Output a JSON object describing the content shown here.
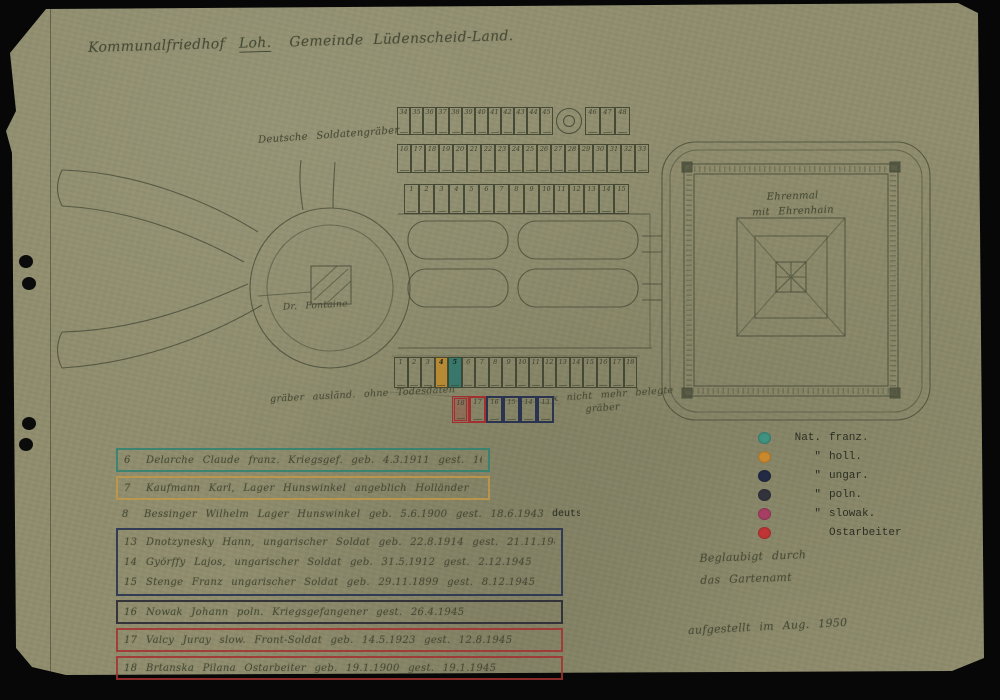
{
  "artifact": {
    "background_color": "#070707",
    "paper_color": "#8f8d6d",
    "ink_color": "#474b36"
  },
  "title": {
    "prefix": "Kommunalfriedhof",
    "underlined": "Loh.",
    "suffix": "Gemeinde Lüdenscheid-Land."
  },
  "plan": {
    "german_graves_label": "Deutsche Soldatengräber",
    "fountain_label": "Dr. Fontaine",
    "memorial_label": [
      "Ehrenmal",
      "mit Ehrenhain"
    ],
    "foreign_graves_label": "gräber ausländ. ohne Todesdaten",
    "unoccupied_note_line1": "x nicht mehr belegte",
    "unoccupied_note_line2": "gräber",
    "grids": {
      "row_top": [
        "34",
        "35",
        "36",
        "37",
        "38",
        "39",
        "40",
        "41",
        "42",
        "43",
        "44",
        "45"
      ],
      "row_top_block": [
        "46",
        "47",
        "48"
      ],
      "row_middle": [
        "16",
        "17",
        "18",
        "19",
        "20",
        "21",
        "22",
        "23",
        "24",
        "25",
        "26",
        "27",
        "28",
        "29",
        "30",
        "31",
        "32",
        "33"
      ],
      "row_bottom": [
        "1",
        "2",
        "3",
        "4",
        "5",
        "6",
        "7",
        "8",
        "9",
        "10",
        "11",
        "12",
        "13",
        "14",
        "15"
      ],
      "foreign_row": [
        "1",
        "2",
        "3",
        "4",
        "5",
        "6",
        "7",
        "8",
        "9",
        "10",
        "11",
        "12",
        "13",
        "14",
        "15",
        "16",
        "17",
        "18"
      ],
      "foreign_highlights": {
        "orange_index": 3,
        "teal_index": 4
      },
      "marked_row": [
        {
          "n": "18",
          "c": "red-heavy"
        },
        {
          "n": "17",
          "c": "red"
        },
        {
          "n": "16",
          "c": "blue"
        },
        {
          "n": "15",
          "c": "blue"
        },
        {
          "n": "14",
          "c": "blue"
        },
        {
          "n": "13",
          "c": "blue"
        }
      ]
    }
  },
  "legend": {
    "items": [
      {
        "color": "#3f9180",
        "prefix": "Nat.",
        "label": "franz."
      },
      {
        "color": "#c8892f",
        "prefix": "\"",
        "label": "holl."
      },
      {
        "color": "#232a45",
        "prefix": "\"",
        "label": "ungar."
      },
      {
        "color": "#33333d",
        "prefix": "\"",
        "label": "poln."
      },
      {
        "color": "#a63f63",
        "prefix": "\"",
        "label": "slowak."
      },
      {
        "color": "#bf3434",
        "prefix": "",
        "label": "Ostarbeiter"
      }
    ]
  },
  "graves_list": [
    {
      "no": "6",
      "text": "Delarche Claude  franz. Kriegsgef.  geb. 4.3.1911  gest. 16.4.1944",
      "typed": ""
    },
    {
      "no": "7",
      "text": "Kaufmann Karl, Lager Hunswinkel  angeblich Holländer",
      "typed": ""
    },
    {
      "no": "8",
      "text": "Bessinger Wilhelm  Lager Hunswinkel  geb. 5.6.1900  gest. 18.6.1943",
      "typed": "deutscher St.Angeh."
    },
    {
      "no": "13",
      "text": "Dnotzynesky Hann,  ungarischer Soldat  geb. 22.8.1914  gest. 21.11.1945",
      "typed": ""
    },
    {
      "no": "14",
      "text": "Györffy Lajos,  ungarischer Soldat  geb. 31.5.1912  gest. 2.12.1945",
      "typed": ""
    },
    {
      "no": "15",
      "text": "Stenge Franz  ungarischer Soldat  geb. 29.11.1899  gest. 8.12.1945",
      "typed": ""
    },
    {
      "no": "16",
      "text": "Nowak Johann  poln. Kriegsgefangener  gest. 26.4.1945",
      "typed": ""
    },
    {
      "no": "17",
      "text": "Valcy Juray  slow. Front-Soldat  geb. 14.5.1923  gest. 12.8.1945",
      "typed": ""
    },
    {
      "no": "18",
      "text": "Brtanska Pilana  Ostarbeiter  geb. 19.1.1900  gest. 19.1.1945",
      "typed": ""
    }
  ],
  "certification": {
    "line1": "Beglaubigt durch",
    "line2": "das Gartenamt",
    "line3": "aufgestellt im Aug. 1950"
  }
}
